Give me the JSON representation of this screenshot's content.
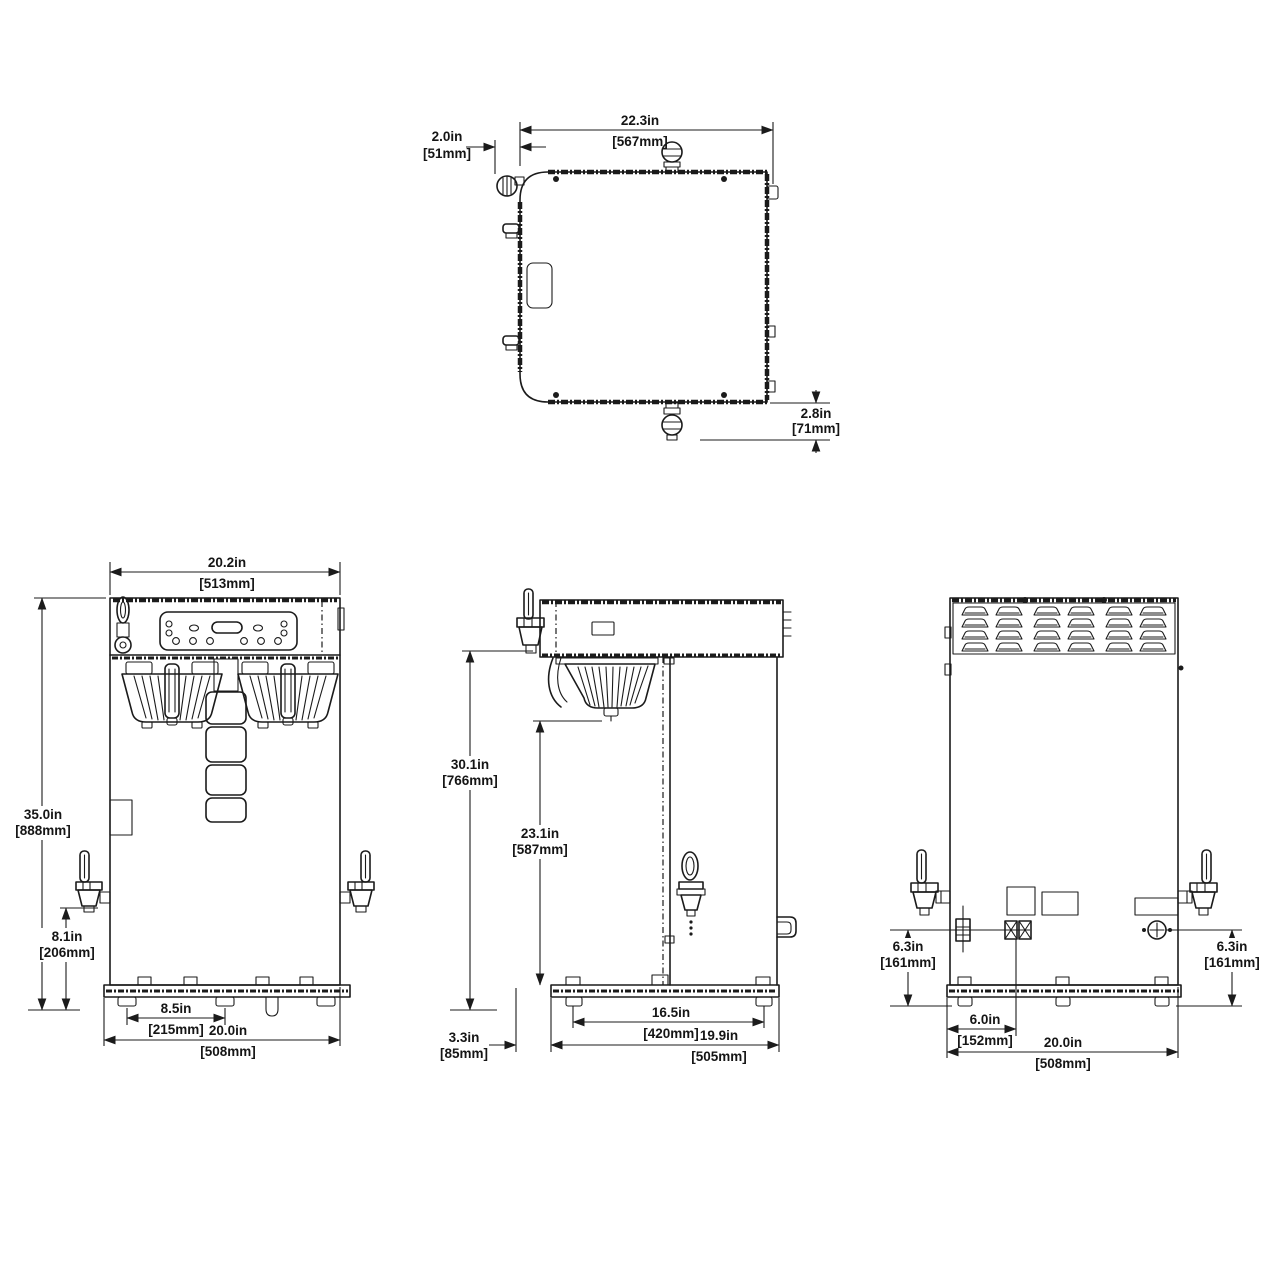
{
  "drawing": {
    "background": "#ffffff",
    "line_color": "#1b1b1b",
    "dims": {
      "top": {
        "width": {
          "in": "22.3in",
          "mm": "[567mm]"
        },
        "offset": {
          "in": "2.0in",
          "mm": "[51mm]"
        },
        "rear": {
          "in": "2.8in",
          "mm": "[71mm]"
        }
      },
      "front": {
        "width": {
          "in": "20.2in",
          "mm": "[513mm]"
        },
        "height": {
          "in": "35.0in",
          "mm": "[888mm]"
        },
        "faucet": {
          "in": "8.1in",
          "mm": "[206mm]"
        },
        "legs": {
          "in": "8.5in",
          "mm": "[215mm]"
        },
        "base": {
          "in": "20.0in",
          "mm": "[508mm]"
        }
      },
      "side": {
        "brew": {
          "in": "30.1in",
          "mm": "[766mm]"
        },
        "clear": {
          "in": "23.1in",
          "mm": "[587mm]"
        },
        "overhang": {
          "in": "3.3in",
          "mm": "[85mm]"
        },
        "legs": {
          "in": "16.5in",
          "mm": "[420mm]"
        },
        "depth": {
          "in": "19.9in",
          "mm": "[505mm]"
        }
      },
      "rear": {
        "left": {
          "in": "6.3in",
          "mm": "[161mm]"
        },
        "right": {
          "in": "6.3in",
          "mm": "[161mm]"
        },
        "offset": {
          "in": "6.0in",
          "mm": "[152mm]"
        },
        "base": {
          "in": "20.0in",
          "mm": "[508mm]"
        }
      }
    }
  }
}
